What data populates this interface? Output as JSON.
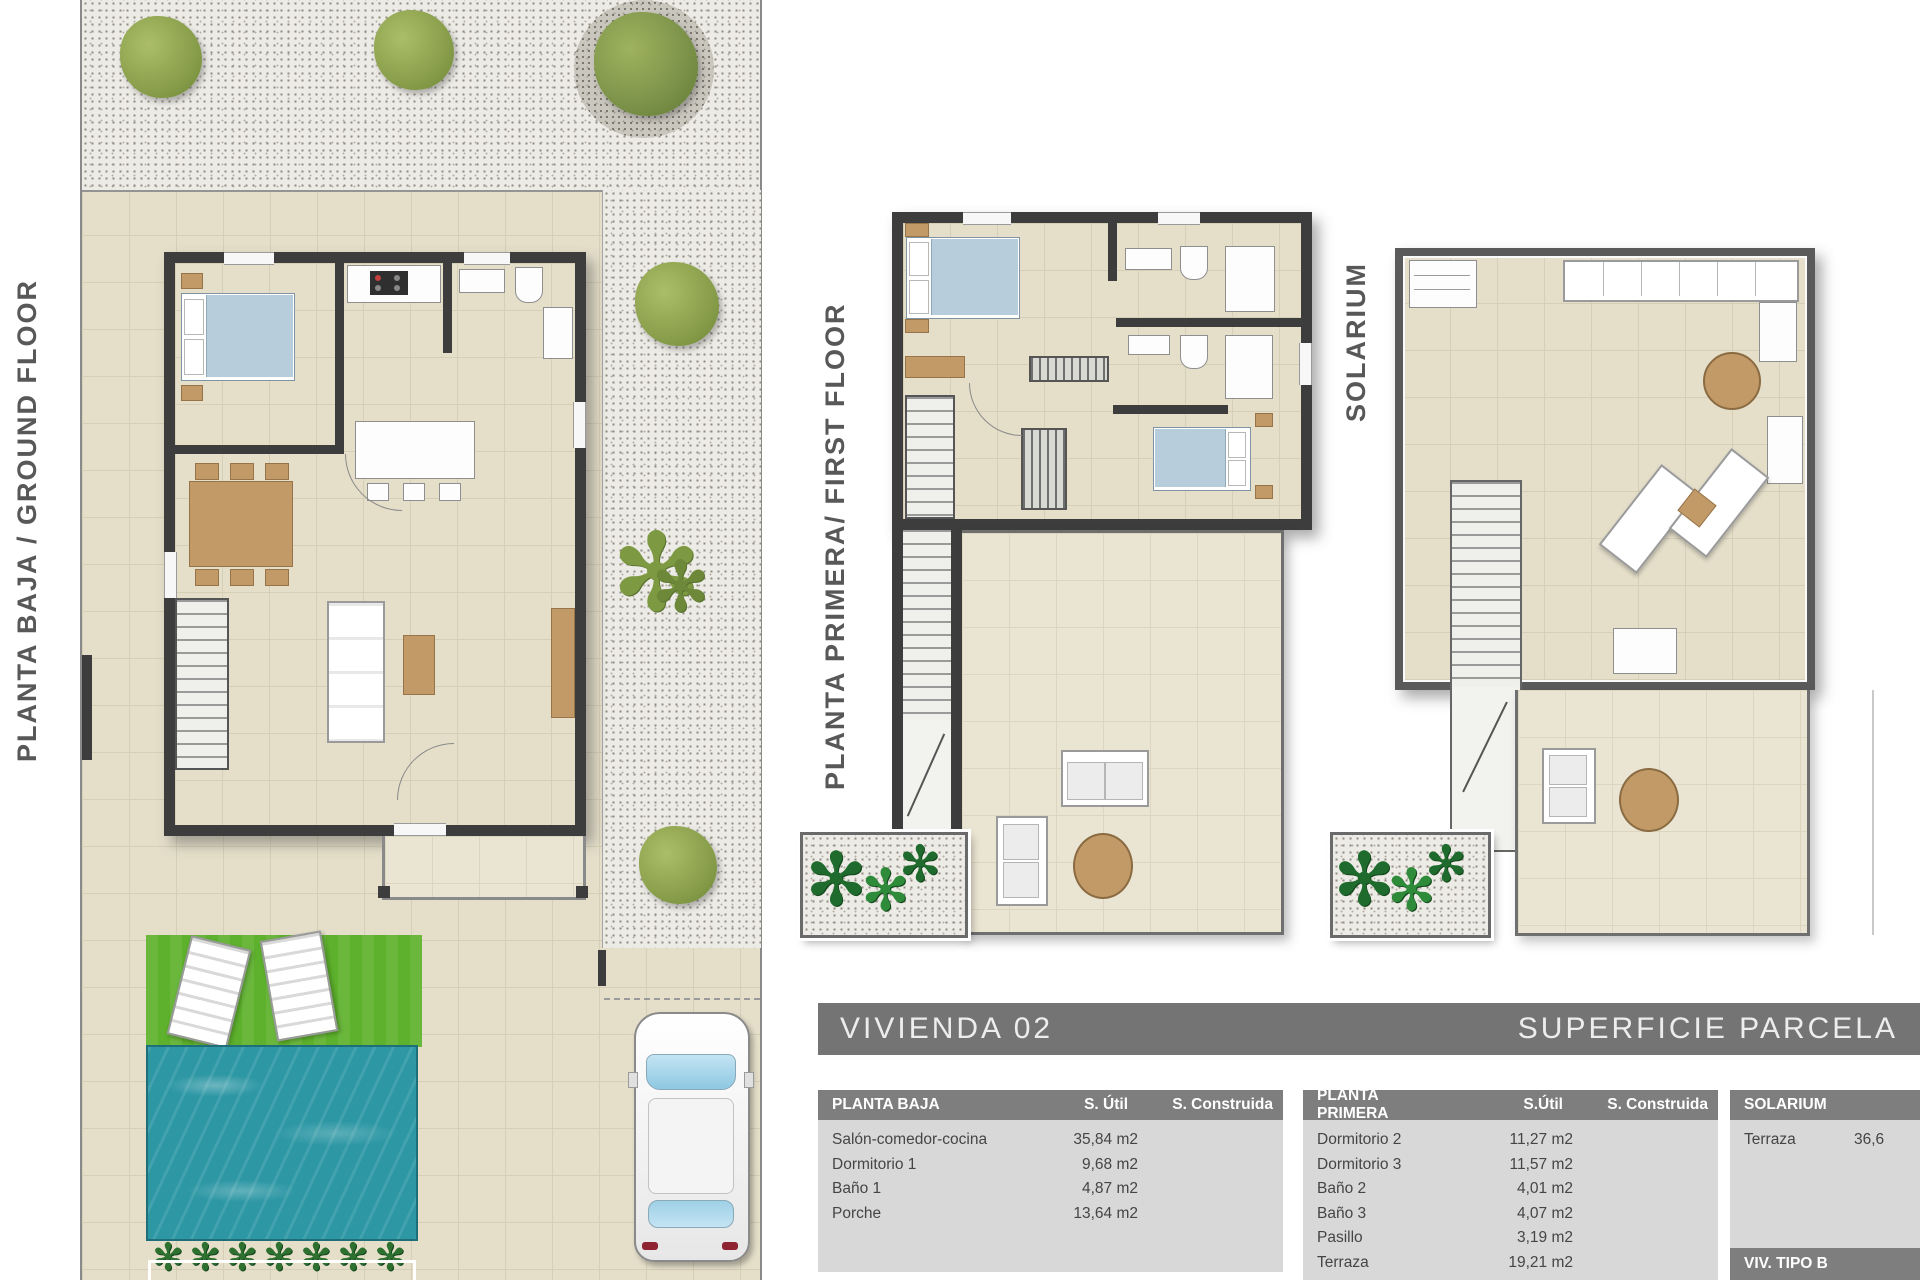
{
  "labels": {
    "ground": "PLANTA BAJA / GROUND FLOOR",
    "first": "PLANTA PRIMERA/ FIRST FLOOR",
    "solarium": "SOLARIUM"
  },
  "title_bar": {
    "left": "VIVIENDA 02",
    "right": "SUPERFICIE PARCELA"
  },
  "tables": {
    "planta_baja": {
      "title": "PLANTA BAJA",
      "col_util": "S. Útil",
      "col_constr": "S. Construida",
      "rows": [
        {
          "name": "Salón-comedor-cocina",
          "util": "35,84 m2"
        },
        {
          "name": "Dormitorio 1",
          "util": "9,68 m2"
        },
        {
          "name": "Baño 1",
          "util": "4,87 m2"
        },
        {
          "name": "Porche",
          "util": "13,64 m2"
        }
      ]
    },
    "planta_primera": {
      "title": "PLANTA PRIMERA",
      "col_util": "S.Útil",
      "col_constr": "S. Construida",
      "rows": [
        {
          "name": "Dormitorio 2",
          "util": "11,27 m2"
        },
        {
          "name": "Dormitorio 3",
          "util": "11,57 m2"
        },
        {
          "name": "Baño 2",
          "util": "4,01 m2"
        },
        {
          "name": "Baño 3",
          "util": "4,07 m2"
        },
        {
          "name": "Pasillo",
          "util": "3,19 m2"
        },
        {
          "name": "Terraza",
          "util": "19,21 m2"
        }
      ]
    },
    "solarium": {
      "title": "SOLARIUM",
      "rows": [
        {
          "name": "Terraza",
          "util": "36,6"
        }
      ],
      "footer": "VIV. TIPO B"
    }
  },
  "icons": {
    "plant": "✻",
    "palm": "✻"
  },
  "colors": {
    "wall": "#3d3d3d",
    "tile": "#e5dfca",
    "bar_gray": "#747474",
    "header_gray": "#7e7e7e",
    "table_body": "#d8d8d8",
    "pool_blue": "#2d97a4",
    "lawn_green": "#5db12c",
    "bed_blue": "#b7cddc",
    "wood_brown": "#c29a67"
  }
}
